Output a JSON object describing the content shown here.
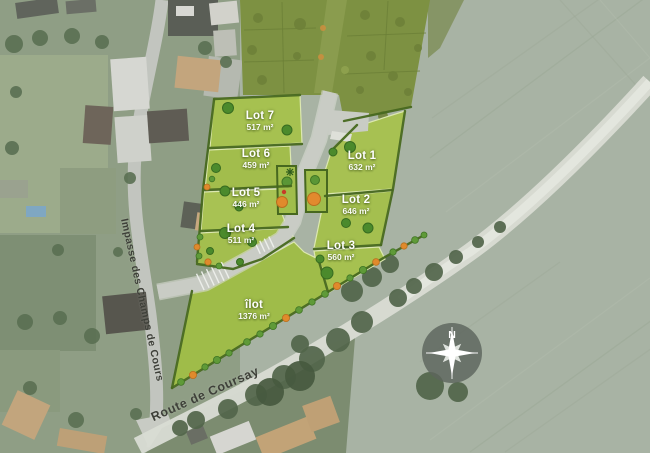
{
  "lots": [
    {
      "name": "Lot 1",
      "area": "632 m²"
    },
    {
      "name": "Lot 2",
      "area": "646 m²"
    },
    {
      "name": "Lot 3",
      "area": "560 m²"
    },
    {
      "name": "Lot 4",
      "area": "511 m²"
    },
    {
      "name": "Lot 5",
      "area": "446 m²"
    },
    {
      "name": "Lot 6",
      "area": "459 m²"
    },
    {
      "name": "Lot 7",
      "area": "517 m²"
    },
    {
      "name": "îlot",
      "area": "1376 m²"
    }
  ],
  "streets": [
    {
      "name": "Impasse des Champs de Cours"
    },
    {
      "name": "Route de Coursay"
    }
  ],
  "compass": {
    "north_label": "N"
  },
  "colors": {
    "lot_green": "#a5c04f",
    "existing_phase_green": "#7d9142",
    "hedge_green": "#47681f",
    "tree_green": "#4b8a2c",
    "shrub_orange": "#e08a2c",
    "accent_red": "#c63b28",
    "plan_road_gray": "#c9ccc5",
    "field_sage": "#a8b3a4",
    "route_road_light": "#d9dcd4",
    "compass_gray": "#5d655d",
    "lot_label_white": "#ffffff",
    "street_label_dark": "#3e4039"
  }
}
